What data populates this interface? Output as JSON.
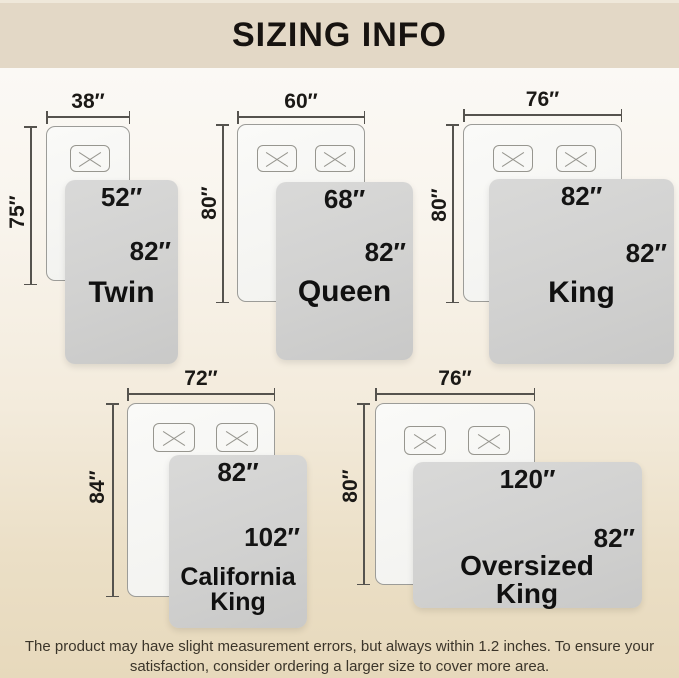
{
  "header": {
    "title": "SIZING INFO"
  },
  "sizes": [
    {
      "name": "Twin",
      "bed_width": "38″",
      "bed_height": "75″",
      "blanket_width": "52″",
      "blanket_height": "82″",
      "pillows": 1
    },
    {
      "name": "Queen",
      "bed_width": "60″",
      "bed_height": "80″",
      "blanket_width": "68″",
      "blanket_height": "82″",
      "pillows": 2
    },
    {
      "name": "King",
      "bed_width": "76″",
      "bed_height": "80″",
      "blanket_width": "82″",
      "blanket_height": "82″",
      "pillows": 2
    },
    {
      "name": "California King",
      "bed_width": "72″",
      "bed_height": "84″",
      "blanket_width": "82″",
      "blanket_height": "102″",
      "pillows": 2
    },
    {
      "name": "Oversized King",
      "bed_width": "76″",
      "bed_height": "80″",
      "blanket_width": "120″",
      "blanket_height": "82″",
      "pillows": 2
    }
  ],
  "footer": {
    "line1": "The product may have slight measurement errors, but always within 1.2 inches. To ensure your",
    "line2": "satisfaction, consider ordering a larger size to cover more area."
  },
  "colors": {
    "header_band": "#e3d8c6",
    "background_bottom": "#e7d9bc",
    "blanket_gray": "#d1d1d0",
    "bed_white": "#f8f8f6",
    "text_dark": "#141414"
  }
}
